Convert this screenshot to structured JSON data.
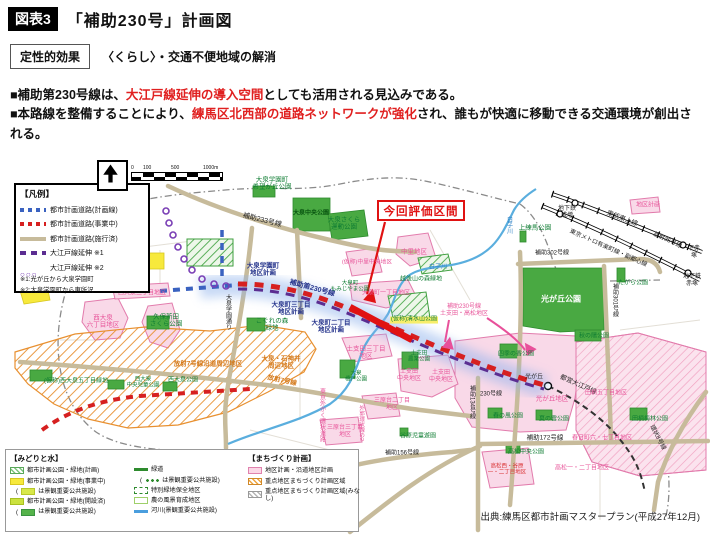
{
  "header": {
    "tag": "図表3",
    "title": "「補助230号」計画図",
    "effect_label": "定性的効果",
    "effect_text": "〈くらし〉・交通不便地域の解消"
  },
  "bullets": [
    [
      {
        "t": "■補助第230号線は、"
      },
      {
        "t": "大江戸線延伸の導入空間",
        "red": true
      },
      {
        "t": "としても活用される見込みである。"
      }
    ],
    [
      {
        "t": "■本路線を整備することにより、"
      },
      {
        "t": "練馬区北西部の道路ネットワークが強化",
        "red": true
      },
      {
        "t": "され、誰もが快適に移動できる交通環境が創出される。"
      }
    ]
  ],
  "legend": {
    "title": "【凡例】",
    "rows": [
      {
        "sw": "tl-blue-dash",
        "t": "都市計画道路(計画線)"
      },
      {
        "sw": "tl-red-dash",
        "t": "都市計画道路(事業中)"
      },
      {
        "sw": "tl-tan",
        "t": "都市計画道路(施行済)"
      },
      {
        "sw": "tl-purple-dash",
        "t": "大江戸線延伸 ※1"
      },
      {
        "sw": "tl-circles",
        "t": "大江戸線延伸 ※2"
      }
    ],
    "notes": [
      "※1:光が丘から大泉学園町",
      "※2:大泉学園町から東所沢"
    ]
  },
  "scale": {
    "ticks": [
      "0",
      "100",
      "500",
      "1000m"
    ]
  },
  "map": {
    "eval_label": "今回評価区間",
    "labels": [
      {
        "t": "大泉学園町\n希望が丘公園",
        "x": 272,
        "y": 184,
        "c": "g"
      },
      {
        "t": "補助233号線",
        "x": 262,
        "y": 221,
        "c": "k",
        "rot": 14,
        "fs": 7
      },
      {
        "t": "大泉中央公園",
        "x": 311,
        "y": 214,
        "c": "gd",
        "fs": 6
      },
      {
        "t": "大泉さくら\n運動公園",
        "x": 344,
        "y": 224,
        "c": "g"
      },
      {
        "t": "上練馬公園",
        "x": 535,
        "y": 228,
        "c": "g"
      },
      {
        "t": "地区計画",
        "x": 648,
        "y": 206,
        "c": "p",
        "fs": 6
      },
      {
        "t": "地下鉄\n成増",
        "x": 567,
        "y": 213,
        "c": "k",
        "fs": 6
      },
      {
        "t": "東武東上線",
        "x": 622,
        "y": 219,
        "c": "k",
        "rot": 21,
        "fs": 6.5
      },
      {
        "t": "東京メトロ有楽町線・副都心線",
        "x": 608,
        "y": 249,
        "c": "k",
        "rot": 24,
        "fs": 6
      },
      {
        "t": "放射35号線",
        "x": 667,
        "y": 241,
        "c": "k",
        "rot": 25,
        "fs": 6
      },
      {
        "t": "下赤塚",
        "x": 694,
        "y": 253,
        "c": "k",
        "fs": 6
      },
      {
        "t": "地下鉄\n赤塚",
        "x": 692,
        "y": 281,
        "c": "k",
        "fs": 6
      },
      {
        "t": "たがら公園",
        "x": 633,
        "y": 284,
        "c": "g",
        "fs": 6
      },
      {
        "t": "補助302号線",
        "x": 552,
        "y": 254,
        "c": "k",
        "fs": 6
      },
      {
        "t": "補助301号線",
        "x": 614,
        "y": 300,
        "c": "k",
        "vert": 1,
        "fs": 6
      },
      {
        "t": "光が丘公園",
        "x": 561,
        "y": 299,
        "c": "w",
        "fs": 8
      },
      {
        "t": "白子川",
        "x": 508,
        "y": 225,
        "c": "b",
        "vert": 1,
        "fs": 6
      },
      {
        "t": "白子川",
        "x": 438,
        "y": 268,
        "c": "b",
        "fs": 6
      },
      {
        "t": "中里地区",
        "x": 414,
        "y": 252,
        "c": "p"
      },
      {
        "t": "(仮称)中里中央地区",
        "x": 367,
        "y": 263,
        "c": "p",
        "fs": 5.8
      },
      {
        "t": "越後山の森緑地",
        "x": 421,
        "y": 280,
        "c": "g",
        "fs": 6
      },
      {
        "t": "大泉町一丁目地区",
        "x": 386,
        "y": 294,
        "c": "p",
        "fs": 6
      },
      {
        "t": "大泉学園町\n地区計画",
        "x": 263,
        "y": 270,
        "c": "n"
      },
      {
        "t": "補助第230号線",
        "x": 312,
        "y": 289,
        "c": "n",
        "rot": 15,
        "fs": 7
      },
      {
        "t": "大泉町三丁目\n地区計画",
        "x": 291,
        "y": 309,
        "c": "n"
      },
      {
        "t": "大泉町二丁目\n地区計画",
        "x": 331,
        "y": 327,
        "c": "n"
      },
      {
        "t": "大泉町\nもみじやま公園",
        "x": 350,
        "y": 287,
        "c": "g",
        "fs": 5.5
      },
      {
        "t": "大泉学園通り",
        "x": 227,
        "y": 312,
        "c": "k",
        "vert": 1,
        "fs": 6
      },
      {
        "t": "こぐれの森\n緑地",
        "x": 272,
        "y": 325,
        "c": "g"
      },
      {
        "t": "西大泉三丁目地区",
        "x": 142,
        "y": 294,
        "c": "p",
        "fs": 6
      },
      {
        "t": "西大泉\n六丁目地区",
        "x": 103,
        "y": 322,
        "c": "p"
      },
      {
        "t": "久保新田\nさくら公園",
        "x": 166,
        "y": 321,
        "c": "g"
      },
      {
        "t": "放射7号線沿道周辺地区",
        "x": 208,
        "y": 364,
        "c": "o",
        "fs": 6.5
      },
      {
        "t": "(仮称)西大泉五丁目緑地",
        "x": 76,
        "y": 382,
        "c": "g",
        "fs": 6
      },
      {
        "t": "西大泉\n中央児童公園",
        "x": 143,
        "y": 383,
        "c": "g",
        "fs": 5.5
      },
      {
        "t": "西大泉公園",
        "x": 183,
        "y": 381,
        "c": "g",
        "fs": 6
      },
      {
        "t": "大泉・石神井\n周辺地区",
        "x": 281,
        "y": 363,
        "c": "o"
      },
      {
        "t": "放射7号線",
        "x": 282,
        "y": 381,
        "c": "o",
        "rot": 12
      },
      {
        "t": "土支田三丁目\n地区",
        "x": 366,
        "y": 353,
        "c": "p"
      },
      {
        "t": "大泉\n橋戸公園",
        "x": 356,
        "y": 377,
        "c": "g",
        "fs": 5.5
      },
      {
        "t": "土支田\n農業公園",
        "x": 419,
        "y": 357,
        "c": "g",
        "fs": 5.5
      },
      {
        "t": "土支田\n中央地区",
        "x": 409,
        "y": 376,
        "c": "p",
        "fs": 6
      },
      {
        "t": "土支田\n中央地区",
        "x": 441,
        "y": 377,
        "c": "p",
        "fs": 6
      },
      {
        "t": "(仮称)清水山公園",
        "x": 414,
        "y": 320,
        "c": "gy",
        "fs": 6
      },
      {
        "t": "補助230号線\n土支田・高松地区",
        "x": 464,
        "y": 311,
        "c": "p",
        "fs": 6
      },
      {
        "t": "四季の香公園",
        "x": 516,
        "y": 355,
        "c": "g",
        "fs": 6
      },
      {
        "t": "秋の陽公園",
        "x": 594,
        "y": 337,
        "c": "g",
        "fs": 6
      },
      {
        "t": "光が丘",
        "x": 534,
        "y": 378,
        "c": "k",
        "fs": 6
      },
      {
        "t": "都営大江戸線",
        "x": 578,
        "y": 385,
        "c": "k",
        "rot": 24
      },
      {
        "t": "230号線",
        "x": 491,
        "y": 395,
        "c": "k",
        "fs": 6
      },
      {
        "t": "光が丘地区",
        "x": 552,
        "y": 399,
        "c": "p"
      },
      {
        "t": "田柄五丁目地区",
        "x": 606,
        "y": 394,
        "c": "p",
        "fs": 6
      },
      {
        "t": "補助134号線",
        "x": 471,
        "y": 402,
        "c": "k",
        "vert": 1,
        "fs": 6
      },
      {
        "t": "春の風公園",
        "x": 508,
        "y": 417,
        "c": "g",
        "fs": 6
      },
      {
        "t": "夏の雲公園",
        "x": 554,
        "y": 420,
        "c": "g",
        "fs": 6
      },
      {
        "t": "田柄梅林公園",
        "x": 650,
        "y": 420,
        "c": "g",
        "fs": 6
      },
      {
        "t": "補助172号線",
        "x": 545,
        "y": 438,
        "c": "k",
        "fs": 6.5
      },
      {
        "t": "春日町六・七丁目地区",
        "x": 602,
        "y": 439,
        "c": "p",
        "fs": 6
      },
      {
        "t": "高松中央公園",
        "x": 526,
        "y": 453,
        "c": "g",
        "fs": 6
      },
      {
        "t": "高松一・二丁目地区",
        "x": 582,
        "y": 469,
        "c": "p",
        "fs": 6
      },
      {
        "t": "高松西・谷原\n一・二丁目地区",
        "x": 507,
        "y": 470,
        "c": "r",
        "fs": 5.5
      },
      {
        "t": "三原台二丁目\n地区",
        "x": 392,
        "y": 405,
        "c": "p",
        "fs": 6
      },
      {
        "t": "三原台三丁目\n地区",
        "x": 345,
        "y": 432,
        "c": "p",
        "fs": 6
      },
      {
        "t": "谷原児童遊園",
        "x": 418,
        "y": 437,
        "c": "g",
        "fs": 6
      },
      {
        "t": "補助156号線",
        "x": 402,
        "y": 454,
        "c": "k",
        "fs": 6
      },
      {
        "t": "東京外かく環状道路",
        "x": 321,
        "y": 415,
        "c": "p",
        "vert": 1,
        "fs": 6
      },
      {
        "t": "外郭環状線の2",
        "x": 361,
        "y": 423,
        "c": "p",
        "vert": 1,
        "fs": 5.5
      },
      {
        "t": "環状8号線",
        "x": 657,
        "y": 438,
        "c": "k",
        "rot": 62,
        "fs": 6
      }
    ]
  },
  "bottom_legend": {
    "left_title": "【みどりと水】",
    "right_title": "【まちづくり計画】",
    "col1": [
      {
        "sw": "sw-hatch-green",
        "t": "都市計画公園・緑地(計画)"
      },
      {
        "sw": "sw-yellow",
        "t": "都市計画公園・緑地(事業中)"
      },
      {
        "pre": "(",
        "sw": "sw-ygreen",
        "t": "は景観重要公共施設)",
        "ind": true
      },
      {
        "sw": "sw-ygreen2",
        "t": "都市計画公園・緑地(開設済)"
      },
      {
        "pre": "(",
        "sw": "sw-green",
        "t": "は景観重要公共施設)",
        "ind": true
      }
    ],
    "col2": [
      {
        "sw": "sw-greenline",
        "t": "緑道"
      },
      {
        "pre": "(",
        "sw": "sw-dots",
        "t": "は景観重要公共施設)",
        "ind": true
      },
      {
        "sw": "sw-greendash",
        "t": "特別緑地保全地区"
      },
      {
        "sw": "sw-lgreenbox",
        "t": "農の風景育成地区"
      },
      {
        "sw": "sw-blueline",
        "t": "河川(景観重要公共施設)"
      }
    ],
    "col3": [
      {
        "sw": "sw-pink",
        "t": "地区計画・沿道地区計画"
      },
      {
        "sw": "sw-hatch-orange",
        "t": "重点地区まちづくり計画区域"
      },
      {
        "sw": "sw-hatch-gray",
        "t": "重点地区まちづくり計画区域(みなし)"
      }
    ]
  },
  "source": "出典:練馬区都市計画マスタープラン(平成27年12月)"
}
